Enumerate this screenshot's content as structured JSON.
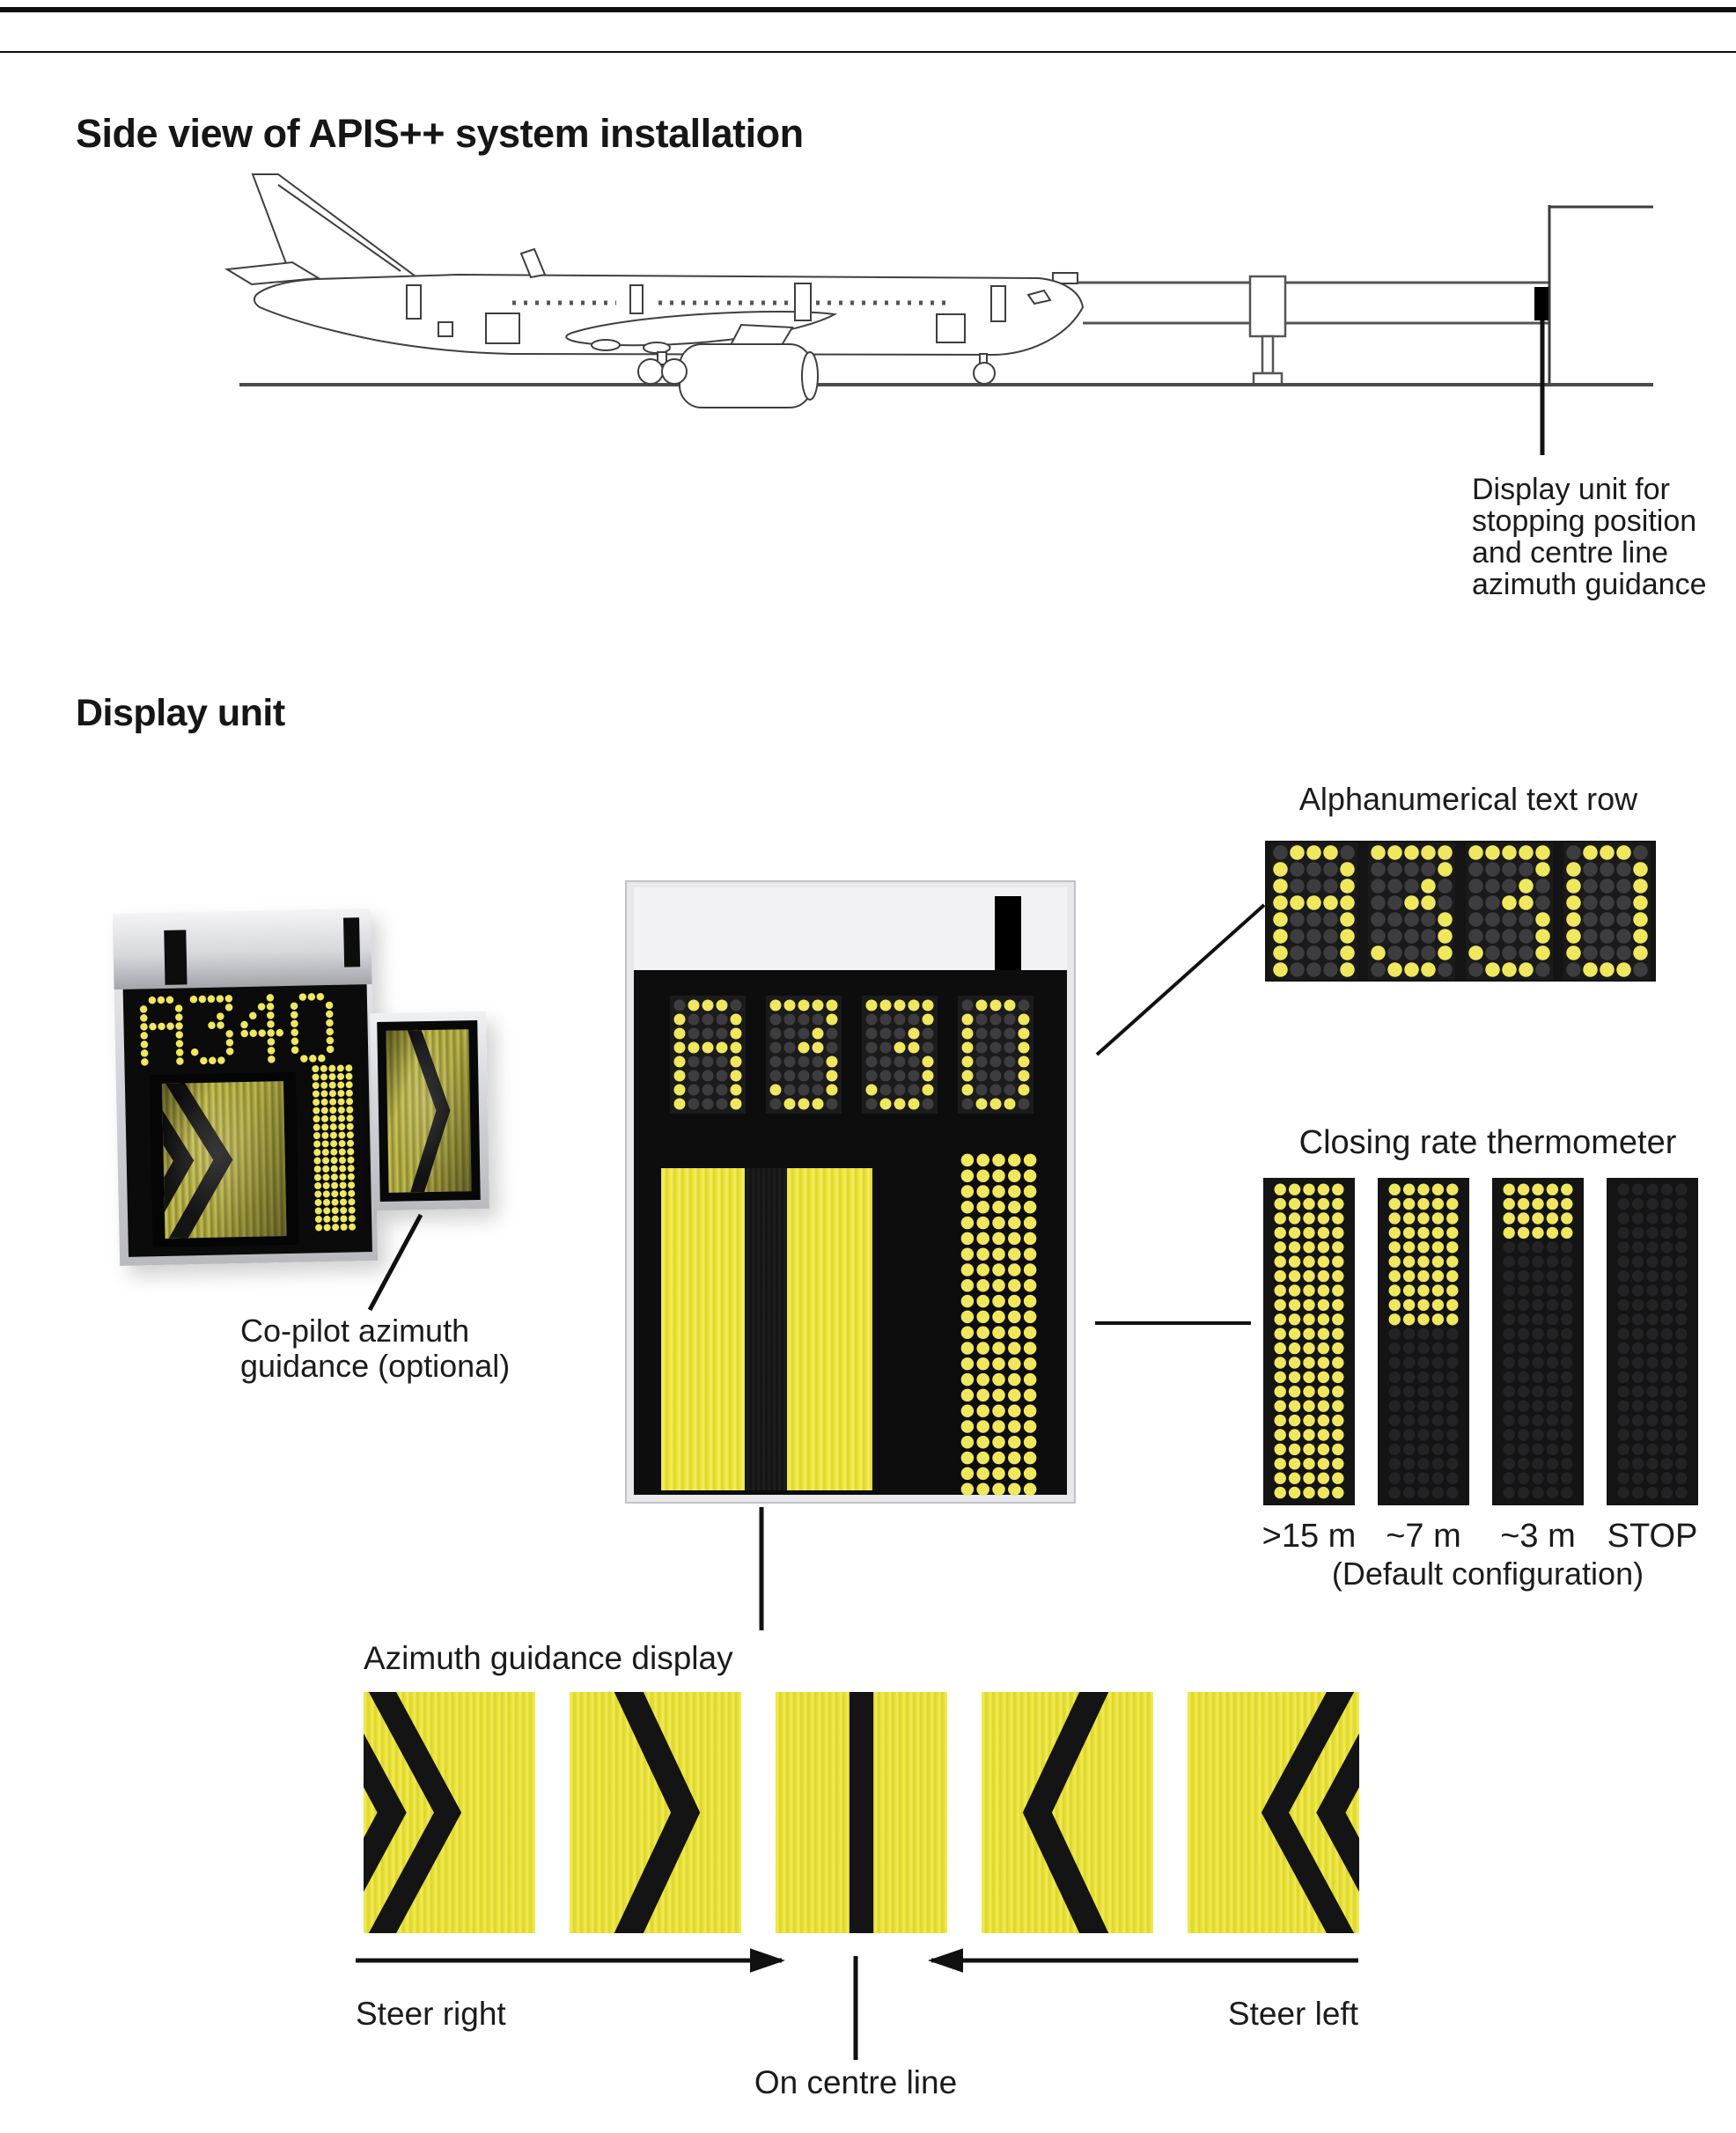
{
  "page": {
    "title": "Side view of APIS++ system installation",
    "display_unit_heading": "Display unit"
  },
  "colors": {
    "led_lit": "#efe75e",
    "led_unlit": "#3d3d40",
    "led_unlit_faint": "#232325",
    "chevron_ink": "#141414",
    "line_ink": "#111111"
  },
  "led_font": {
    "A": [
      "01110",
      "10001",
      "10001",
      "11111",
      "10001",
      "10001",
      "10001",
      "10001"
    ],
    "3": [
      "11111",
      "00001",
      "00010",
      "00110",
      "00001",
      "00001",
      "10001",
      "01110"
    ],
    "4": [
      "00010",
      "00110",
      "01010",
      "10010",
      "11111",
      "00010",
      "00010",
      "00010"
    ],
    "0": [
      "01110",
      "10001",
      "10001",
      "10001",
      "10001",
      "10001",
      "10001",
      "01110"
    ]
  },
  "installation": {
    "display_unit_label_lines": [
      "Display unit for",
      "stopping position",
      "and centre line",
      "azimuth guidance"
    ]
  },
  "photo_unit": {
    "text": "A340",
    "main_chevron": "double-right",
    "copilot_chevron": "single-right",
    "thermometer_lit_rows": 20,
    "thermometer_rows": 20,
    "copilot_label_lines": [
      "Co-pilot azimuth",
      "guidance (optional)"
    ]
  },
  "central_display": {
    "text": "A330",
    "azimuth_state": "on-centre-line",
    "thermometer_lit_rows": 22,
    "thermometer_rows": 22
  },
  "alphanumerical": {
    "label": "Alphanumerical text row",
    "text": "A330"
  },
  "thermometer": {
    "label": "Closing rate thermometer",
    "rows": 22,
    "cols": 5,
    "columns": [
      {
        "label": ">15 m",
        "lit_rows": 22
      },
      {
        "label": "~7 m",
        "lit_rows": 10
      },
      {
        "label": "~3 m",
        "lit_rows": 4
      },
      {
        "label": "STOP",
        "lit_rows": 0
      }
    ],
    "note": "(Default configuration)"
  },
  "azimuth": {
    "label": "Azimuth guidance display",
    "panels": [
      "double-right",
      "single-right",
      "centre-line",
      "single-left",
      "double-left"
    ],
    "steer_right": "Steer right",
    "steer_left": "Steer left",
    "on_centre_line": "On centre line"
  }
}
